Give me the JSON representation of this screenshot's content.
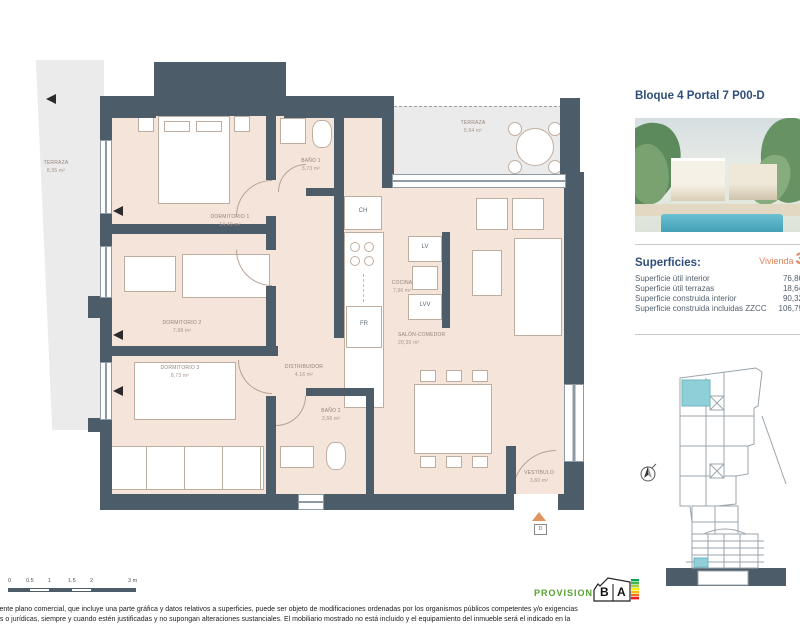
{
  "colors": {
    "wall": "#4d5c69",
    "floor": "#f4e4da",
    "terrace": "#ebebeb",
    "navy": "#2f4d7c",
    "accent_orange": "#e2845c",
    "unit_highlight_teal": "#8fd0d8",
    "provisional_green": "#56a332"
  },
  "panel": {
    "title": "Bloque 4 Portal 7 P00-D",
    "superficies_heading": "Superficies:",
    "vivienda_word": "Vivienda",
    "vivienda_number": "3",
    "surface_rows": [
      {
        "label": "Superficie útil interior",
        "value": "76,86"
      },
      {
        "label": "Superficie útil terrazas",
        "value": "18,64"
      },
      {
        "label": "Superficie construida interior",
        "value": "90,32"
      },
      {
        "label": "Superficie construida incluidas ZZCC",
        "value": "106,79"
      }
    ]
  },
  "plan": {
    "rooms": [
      {
        "name": "TERRAZA",
        "area": "8,95 m²"
      },
      {
        "name": "DORMITORIO 1",
        "area": "14,49 m²"
      },
      {
        "name": "DORMITORIO 2",
        "area": "7,98 m²"
      },
      {
        "name": "DORMITORIO 3",
        "area": "8,73 m²"
      },
      {
        "name": "BAÑO 1",
        "area": "3,73 m²"
      },
      {
        "name": "COCINA",
        "area": "7,96 m²"
      },
      {
        "name": "TERRAZA",
        "area": "5,94 m²"
      },
      {
        "name": "SALÓN-COMEDOR",
        "area": "20,30 m²"
      },
      {
        "name": "DISTRIBUIDOR",
        "area": "4,16 m²"
      },
      {
        "name": "BAÑO 2",
        "area": "3,66 m²"
      },
      {
        "name": "VESTÍBULO",
        "area": "3,60 m²"
      }
    ],
    "fixtures": {
      "ch": "CH",
      "lv": "LV",
      "lvv": "LVV",
      "fr": "FR",
      "entrance": "D"
    }
  },
  "scalebar": {
    "ticks": [
      "0",
      "0.5",
      "1",
      "1.5",
      "2",
      "3 m"
    ]
  },
  "footer": {
    "provisional": "PROVISIONAL",
    "energy": {
      "letter1": "B",
      "letter2": "A"
    },
    "disclaimer_line1": "sente plano comercial, que incluye una parte gráfica y datos relativos a superficies, puede ser objeto de modificaciones ordenadas por los organismos públicos competentes y/o exigencias",
    "disclaimer_line2": "as o jurídicas, siempre y cuando estén justificadas y no supongan alteraciones sustanciales. El mobiliario mostrado no está incluido y el equipamiento del inmueble será el indicado en la"
  }
}
